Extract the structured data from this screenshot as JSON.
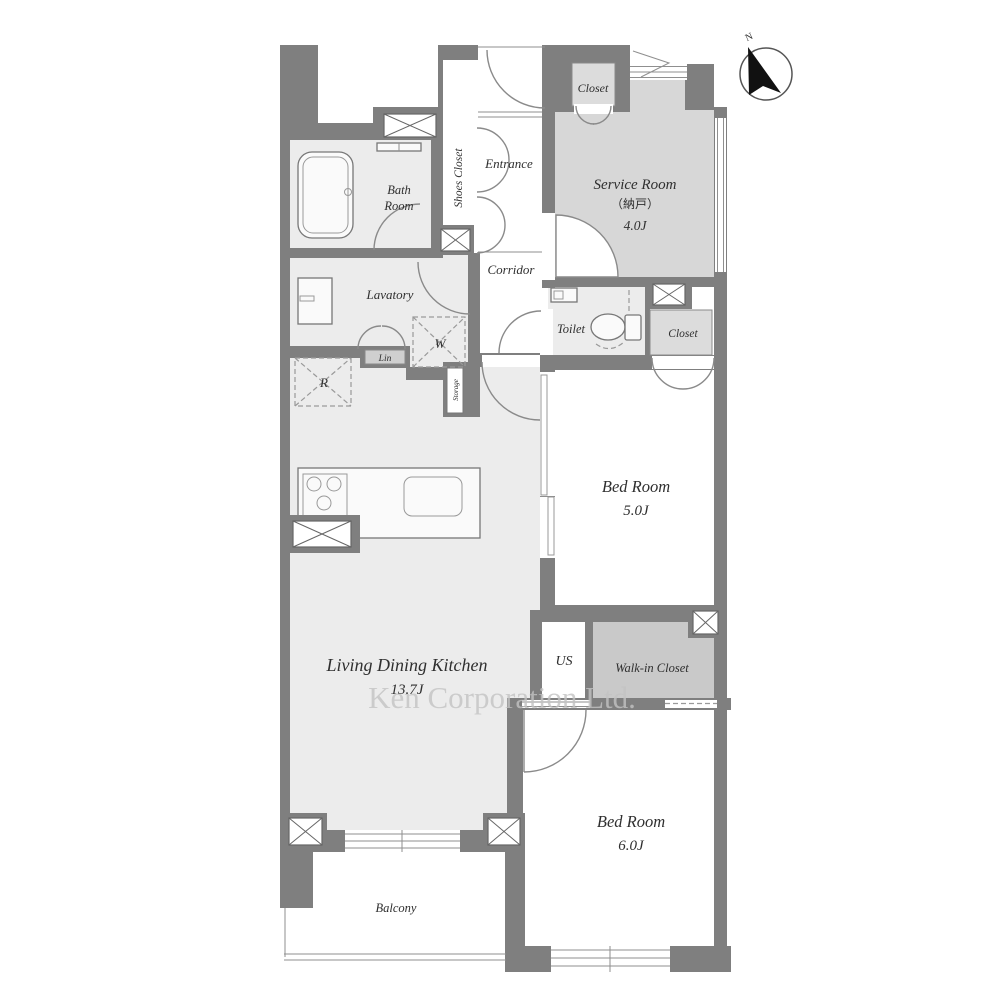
{
  "page": {
    "background": "#ffffff"
  },
  "compass": {
    "north_label": "N"
  },
  "watermark": {
    "text": "Ken Corporation Ltd."
  },
  "colors": {
    "wall": "#7f7f7f",
    "room_light": "#ececec",
    "room_service": "#d7d7d7",
    "room_closet": "#dcdcdc",
    "room_walk_in_closet": "#c9c9c9",
    "line": "#777777",
    "text": "#2f2f2f",
    "watermark": "#c3c3c3"
  },
  "rooms": {
    "bath": {
      "line1": "Bath",
      "line2": "Room"
    },
    "shoes_closet": {
      "label": "Shoes Closet"
    },
    "entrance": {
      "label": "Entrance"
    },
    "closet_upper": {
      "label": "Closet"
    },
    "service_room": {
      "name": "Service Room",
      "name_jp": "（納戸）",
      "size": "4.0J"
    },
    "corridor": {
      "label": "Corridor"
    },
    "lavatory": {
      "label": "Lavatory"
    },
    "toilet": {
      "label": "Toilet"
    },
    "closet_bed5": {
      "label": "Closet"
    },
    "bedroom5": {
      "name": "Bed Room",
      "size": "5.0J"
    },
    "ldk": {
      "name": "Living Dining Kitchen",
      "size": "13.7J"
    },
    "us": {
      "label": "US"
    },
    "walk_in_closet": {
      "label": "Walk-in Closet"
    },
    "bedroom6": {
      "name": "Bed Room",
      "size": "6.0J"
    },
    "balcony": {
      "label": "Balcony"
    },
    "linen": {
      "label": "Lin"
    },
    "storage": {
      "label": "Storage"
    },
    "washing_machine": {
      "label": "W"
    },
    "refrigerator": {
      "label": "R"
    }
  }
}
